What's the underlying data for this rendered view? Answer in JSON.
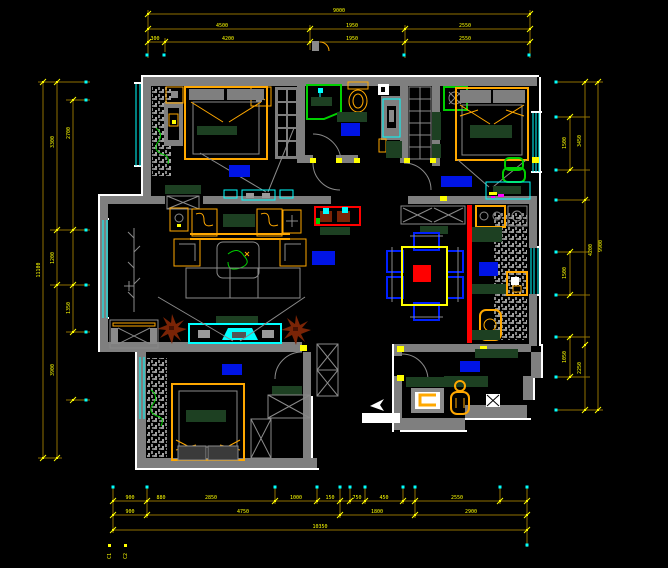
{
  "drawing": {
    "kind": "residential apartment floor plan, CAD furniture layout on black model space",
    "background": "#000000"
  },
  "colors": {
    "dim_line": "#8f7100",
    "dim_text": "#ffff00",
    "wall": "#7f7f7f",
    "outline": "#ffffff",
    "window": "#00ffff",
    "room_label_block": "#0014e6",
    "furniture_frame": "#ffa800",
    "soft_furnishing": "#1d4022",
    "plant_green": "#00d000",
    "plant_brown": "#7a2406",
    "feature_red": "#ff0000",
    "dining_chair_blue": "#0020ff",
    "table_yellow": "#ffff00"
  },
  "dims": {
    "top": {
      "total": "9000",
      "mid": [
        "4500",
        "1950",
        "2550"
      ],
      "inner": [
        "300",
        "4200",
        "1950",
        "2550"
      ]
    },
    "bottom": {
      "inner": [
        "900",
        "880",
        "2850",
        "1000",
        "150",
        "750",
        "450",
        "2550"
      ],
      "mid": [
        "900",
        "4750",
        "1800",
        "2900"
      ],
      "total": "10350"
    },
    "left": {
      "total": "11100",
      "mid": [
        "3300",
        "1200",
        "3900"
      ],
      "inner": [
        "2700",
        "1350"
      ]
    },
    "right": {
      "total": "9900",
      "mid": [
        "3450",
        "4200",
        "2250"
      ],
      "inner": [
        "1500",
        "1500",
        "1050"
      ]
    },
    "corner_tags": [
      "C1",
      "C2"
    ]
  }
}
